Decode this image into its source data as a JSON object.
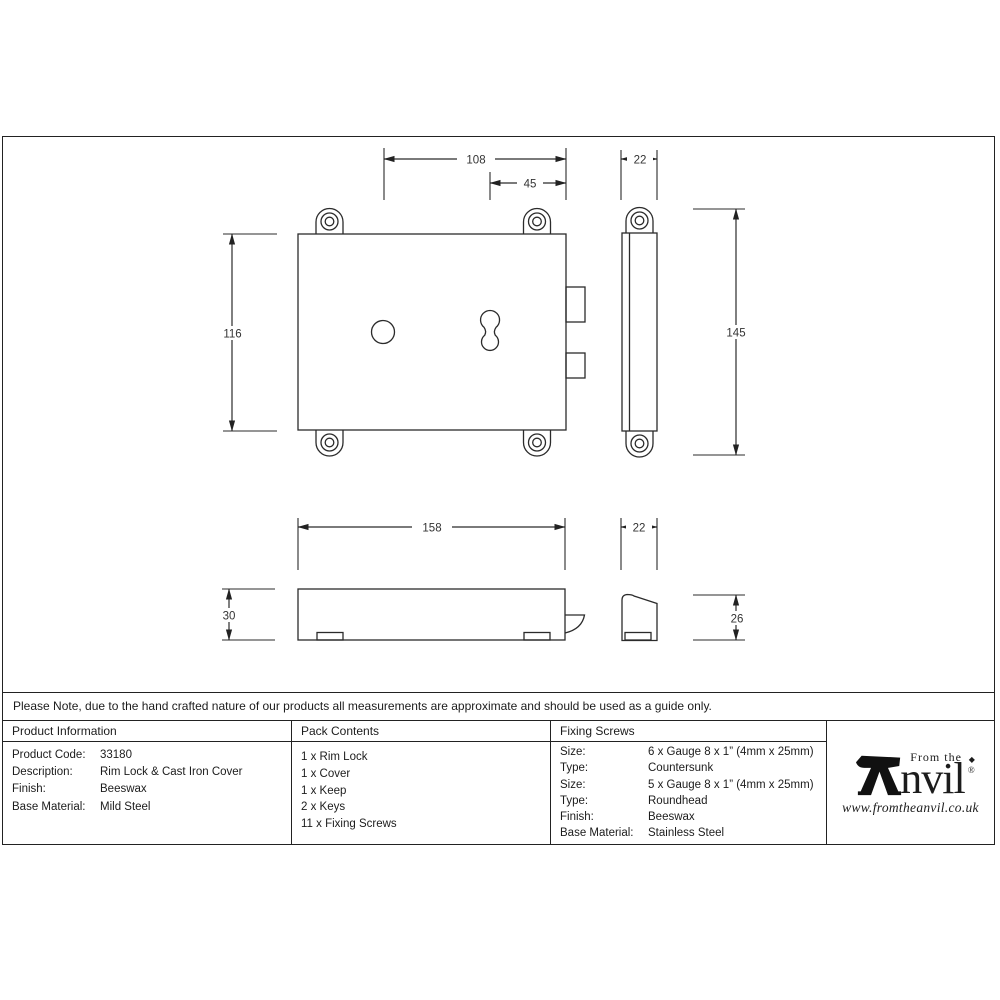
{
  "note": {
    "text": "Please Note, due to the hand crafted nature of our products all measurements are approximate and should be used as a guide only."
  },
  "drawing": {
    "dims": {
      "front_hole_to_edge": "108",
      "keyhole_to_edge": "45",
      "case_depth": "22",
      "case_height": "116",
      "overall_height": "145",
      "keep_length": "158",
      "keep_height": "30",
      "keep_depth": "22",
      "keep_side_height": "26"
    }
  },
  "table": {
    "product_information": {
      "header": "Product Information",
      "rows": [
        {
          "label": "Product Code:",
          "value": "33180"
        },
        {
          "label": "Description:",
          "value": "Rim Lock & Cast Iron Cover"
        },
        {
          "label": "Finish:",
          "value": "Beeswax"
        },
        {
          "label": "Base Material:",
          "value": "Mild Steel"
        }
      ]
    },
    "pack_contents": {
      "header": "Pack Contents",
      "items": [
        "1 x Rim Lock",
        "1 x Cover",
        "1 x Keep",
        "2 x Keys",
        "11 x Fixing Screws"
      ]
    },
    "fixing_screws": {
      "header": "Fixing Screws",
      "rows": [
        {
          "label": "Size:",
          "value": "6 x Gauge 8 x 1” (4mm x 25mm)"
        },
        {
          "label": "Type:",
          "value": "Countersunk"
        },
        {
          "label": "Size:",
          "value": "5 x Gauge 8 x 1” (4mm x 25mm)"
        },
        {
          "label": "Type:",
          "value": "Roundhead"
        },
        {
          "label": "Finish:",
          "value": "Beeswax"
        },
        {
          "label": "Base Material:",
          "value": "Stainless Steel"
        }
      ]
    }
  },
  "logo": {
    "tagline": "From the",
    "wordmark_suffix": "nvil",
    "registered": "®",
    "diamond": "◆",
    "url": "www.fromtheanvil.co.uk"
  },
  "colors": {
    "ink": "#222222",
    "dim_text": "#333333",
    "background": "#ffffff"
  }
}
